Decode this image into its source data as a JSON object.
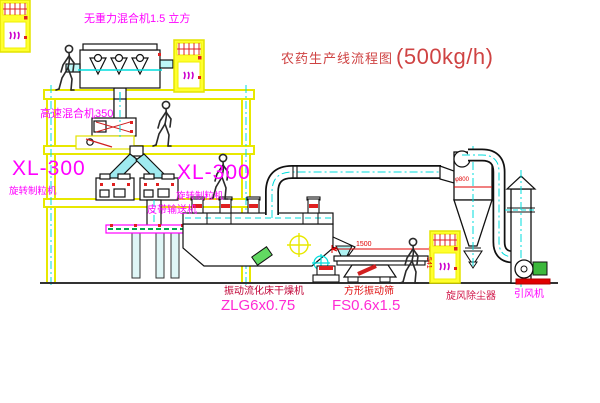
{
  "title": {
    "text": "农药生产线流程图",
    "capacity": "(500kg/h)"
  },
  "labels": {
    "top_mixer": "无重力混合机1.5 立方",
    "high_speed_mixer": "高速混合机350",
    "granulator_left_model": "XL-300",
    "granulator_left_name": "旋转制粒机",
    "granulator_right_model": "XL-300",
    "granulator_right_name": "旋转制粒机",
    "belt_conveyor": "皮带输送机",
    "dryer_name": "振动流化床干燥机",
    "dryer_model": "ZLG6x0.75",
    "sieve_name": "方形振动筛",
    "sieve_model": "FS0.6x1.5",
    "cyclone": "旋风除尘器",
    "fan": "引风机"
  },
  "dimensions": {
    "sieve_length": "1500",
    "sieve_height": "541",
    "cyclone_diameter": "φ800"
  },
  "colors": {
    "label_magenta": "#ff00ff",
    "model_pink": "#ff2ad4",
    "title_red": "#cf4343",
    "dimension_red": "#e00000",
    "frame_yellow": "#e8e800",
    "centerline_cyan": "#00dddd",
    "belt_green": "#00a650",
    "motor_green": "#3cb83c"
  }
}
